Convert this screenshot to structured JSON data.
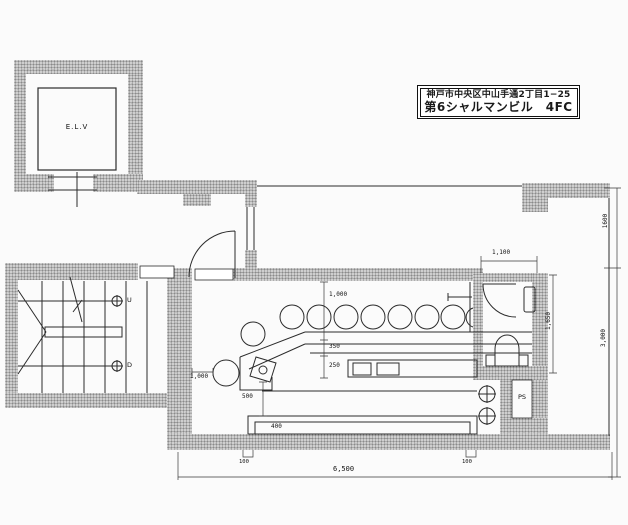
{
  "title_block": {
    "address": "神戸市中央区中山手通2丁目1−25",
    "building": "第6シャルマンビル　4FC"
  },
  "rooms": {
    "elevator": "E.L.V",
    "pipe_space": "PS",
    "stairs_up": "U",
    "stairs_down": "D"
  },
  "dimensions": {
    "stool_clearance_left": "1,000",
    "counter_clearance_top": "1,000",
    "counter_depth": "350",
    "backbar_depth": "250",
    "bench_clearance": "500",
    "bench_depth": "400",
    "pillar_left": "100",
    "pillar_right": "100",
    "overall_width": "6,500",
    "toilet_width": "1,100",
    "toilet_depth": "1,650",
    "balcony_depth": "1600",
    "room_depth": "3,000"
  },
  "colors": {
    "paper": "#fbfbfb",
    "wall_fill": "#cfcfcf",
    "line": "#2b2b2b"
  }
}
